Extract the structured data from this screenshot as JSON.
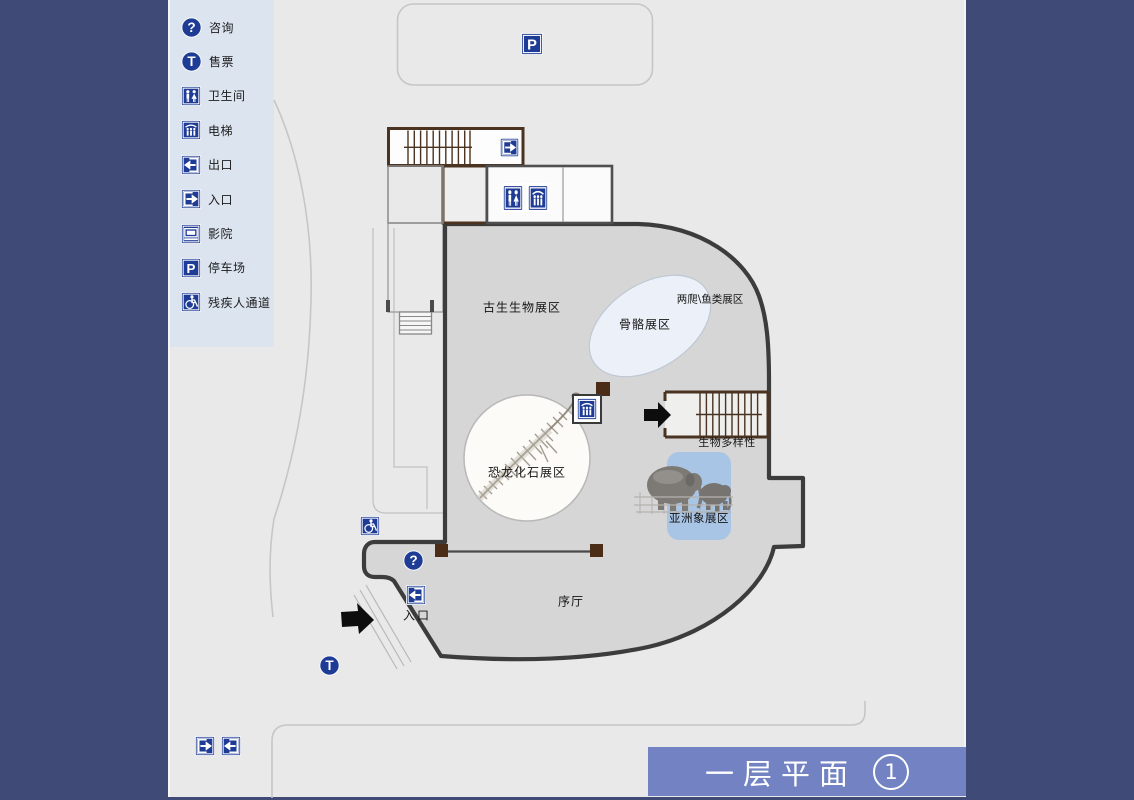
{
  "legend": {
    "items": [
      {
        "icon": "info-icon",
        "label": "咨询"
      },
      {
        "icon": "ticket-icon",
        "label": "售票"
      },
      {
        "icon": "restroom-icon",
        "label": "卫生间"
      },
      {
        "icon": "elevator-icon",
        "label": "电梯"
      },
      {
        "icon": "exit-icon",
        "label": "出口"
      },
      {
        "icon": "entrance-icon",
        "label": "入口"
      },
      {
        "icon": "cinema-icon",
        "label": "影院"
      },
      {
        "icon": "parking-icon",
        "label": "停车场"
      },
      {
        "icon": "accessible-icon",
        "label": "残疾人通道"
      }
    ]
  },
  "map": {
    "areas": {
      "paleontology": "古生生物展区",
      "skeleton": "骨骼展区",
      "amphibian_fish": "两爬\\鱼类展区",
      "dinosaur": "恐龙化石展区",
      "biodiversity": "生物多样性",
      "asian_elephant": "亚洲象展区",
      "foyer": "序厅",
      "entrance": "入口"
    },
    "colors": {
      "frame_navy": "#404a76",
      "content_bg": "#e9e9e9",
      "legend_panel_bg": "#dce4f0",
      "building_fill": "#d6d6d6",
      "building_wall": "#3c3c3c",
      "stair_brown": "#4a3320",
      "icon_blue": "#1e3c96",
      "skeleton_area_fill": "#ecf1f9",
      "elephant_area_fill": "#a9c5e6",
      "banner_bg": "#7282c2"
    }
  },
  "title_bar": {
    "text": "一层平面",
    "badge": "1"
  }
}
